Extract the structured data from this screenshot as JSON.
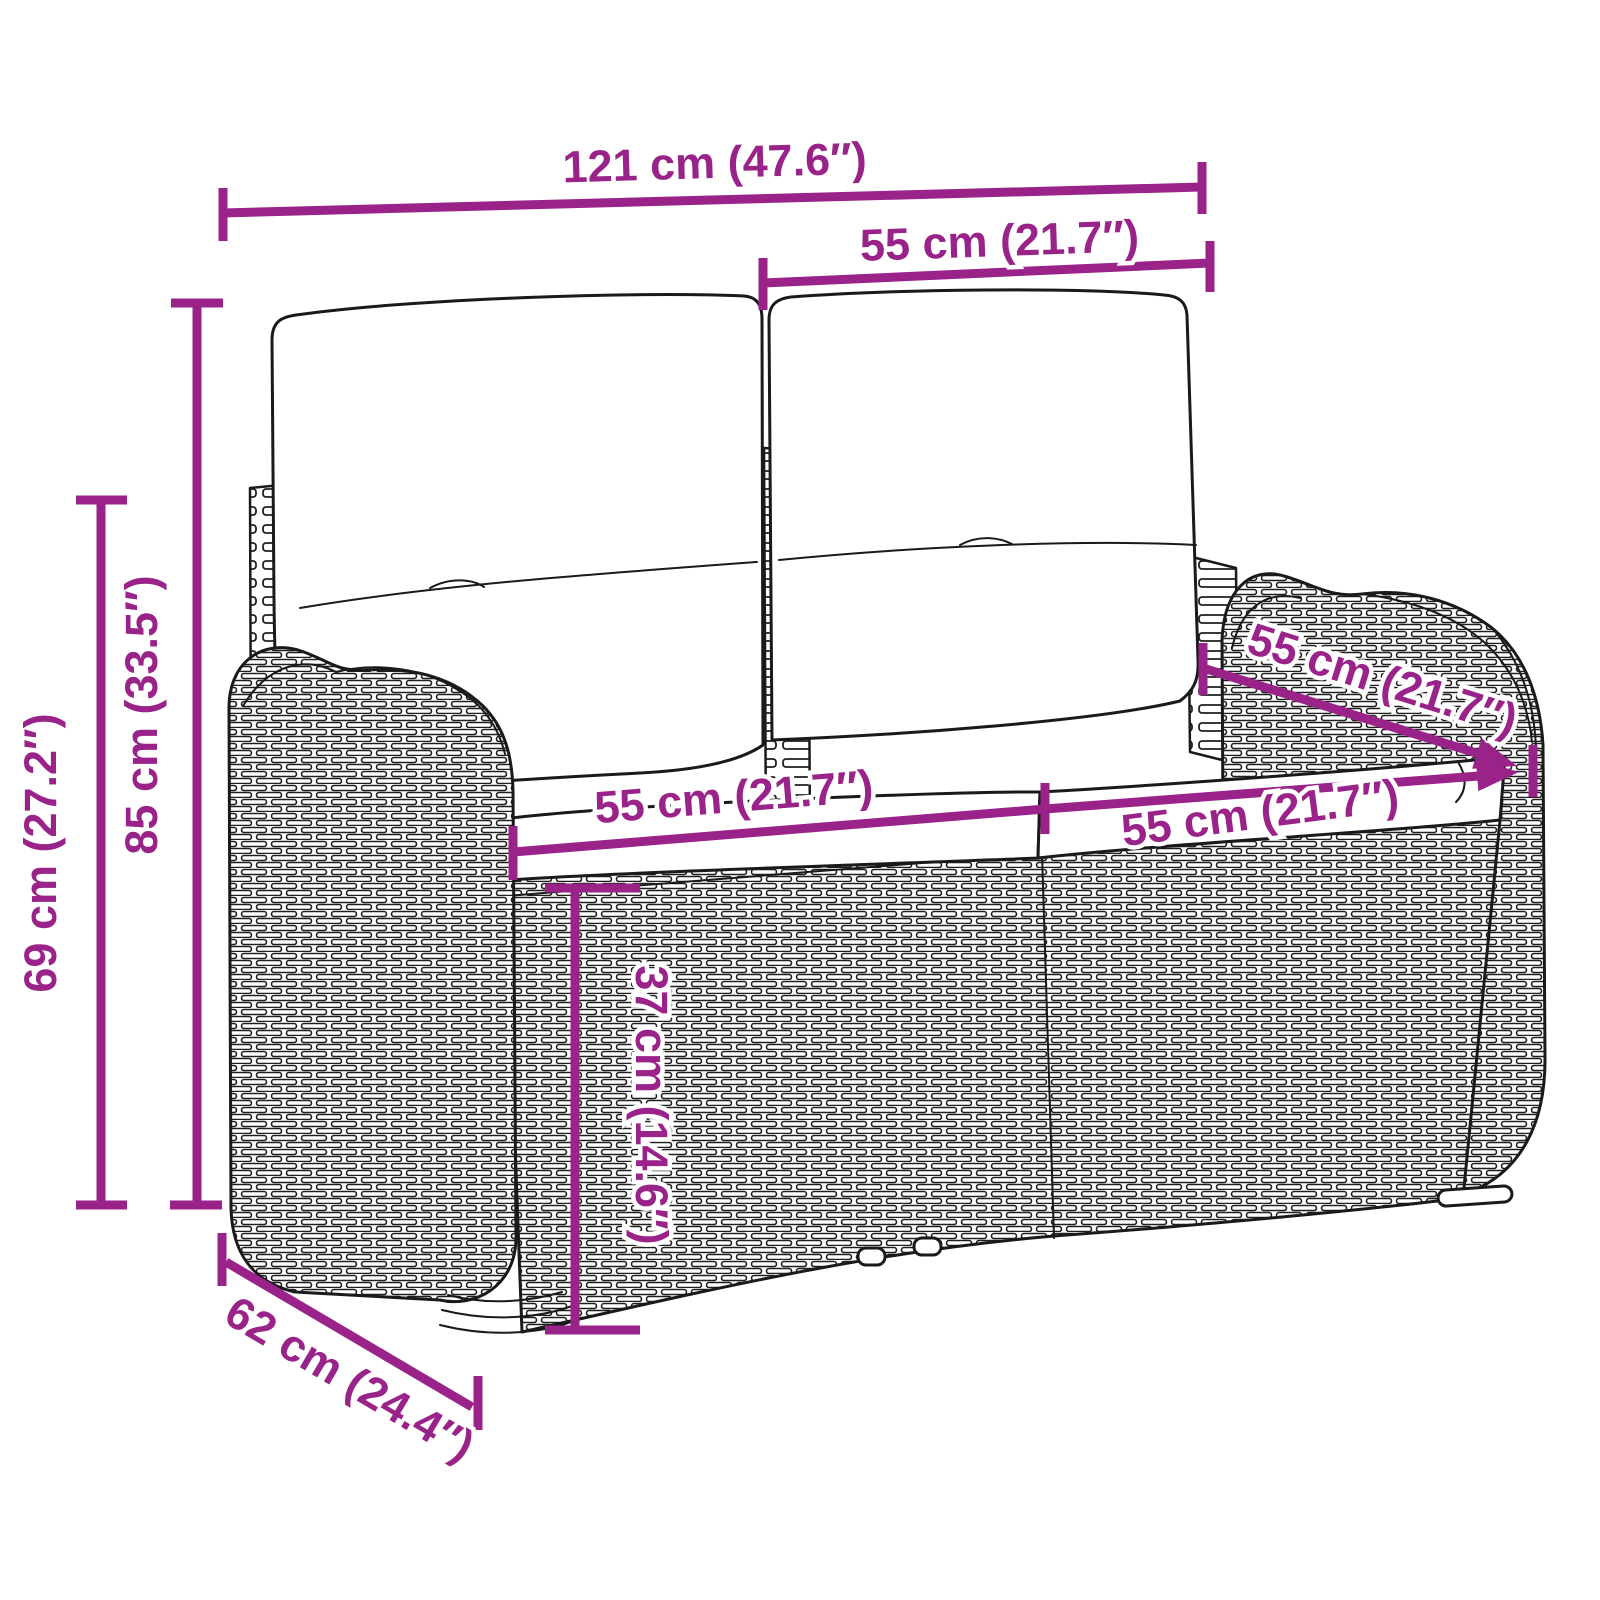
{
  "figure": {
    "kind": "product-dimension-diagram",
    "subject": "2-seater poly rattan garden bench with back and seat cushions",
    "style": "black line-art drawing on white with purple dimension annotations"
  },
  "colors": {
    "dimension_accent": "#9a238a",
    "line_art": "#1a1a1a",
    "background": "#ffffff"
  },
  "dims": {
    "total_width": "121 cm (47.6″)",
    "back_cushion_width": "55 cm (21.7″)",
    "total_height": "85 cm (33.5″)",
    "side_height": "69 cm (27.2″)",
    "seat_width_left": "55 cm (21.7″)",
    "seat_width_right": "55 cm (21.7″)",
    "seat_depth": "55 cm (21.7″)",
    "seat_height": "37 cm (14.6″)",
    "base_depth": "62 cm (24.4″)"
  }
}
